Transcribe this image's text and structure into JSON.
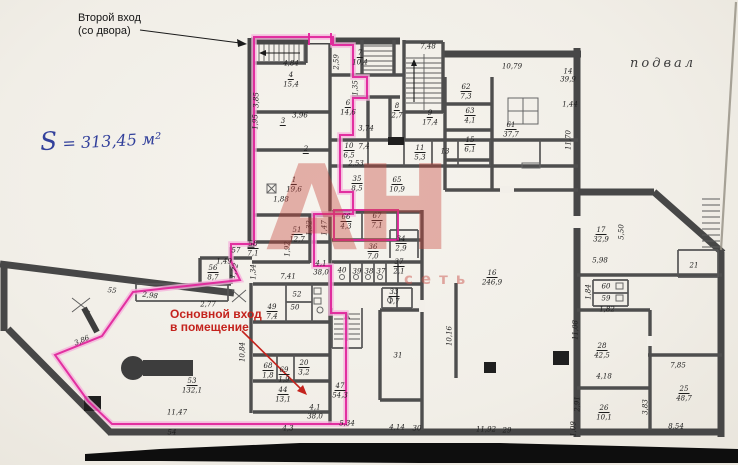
{
  "annotations": {
    "second_entrance_line1": "Второй вход",
    "second_entrance_line2": "(со двора)",
    "floor_label": "подвал",
    "handwritten_area_s": "S",
    "handwritten_area_rest": "= 313,45 м²",
    "main_entrance_line1": "Основной вход",
    "main_entrance_line2": "в помещение"
  },
  "watermark": {
    "big_text": "АН",
    "small_text": "сеть"
  },
  "colors": {
    "highlight_magenta": "#e0249a",
    "entrance_red": "#c4231d",
    "handwriting_blue": "#32409b",
    "wall_gray": "#4a4a4a",
    "paper": "#f2efe9",
    "scan_band_black": "#0e0e0e",
    "watermark_red": "#cc5a52"
  },
  "plan": {
    "labels": [
      {
        "t": "4",
        "x": 291,
        "y": 76,
        "cl": "rn"
      },
      {
        "t": "15,4",
        "x": 291,
        "y": 85
      },
      {
        "t": "3",
        "x": 283,
        "y": 122,
        "cl": "rn"
      },
      {
        "t": "2",
        "x": 306,
        "y": 150,
        "cl": "rn"
      },
      {
        "t": "1",
        "x": 294,
        "y": 181,
        "cl": "rn"
      },
      {
        "t": "19,6",
        "x": 294,
        "y": 190
      },
      {
        "t": "51",
        "x": 297,
        "y": 231,
        "cl": "rn"
      },
      {
        "t": "12,7",
        "x": 297,
        "y": 240
      },
      {
        "t": "58",
        "x": 253,
        "y": 245,
        "cl": "rn"
      },
      {
        "t": "7,1",
        "x": 253,
        "y": 254
      },
      {
        "t": "56",
        "x": 213,
        "y": 269,
        "cl": "rn"
      },
      {
        "t": "8,7",
        "x": 213,
        "y": 278
      },
      {
        "t": "7",
        "x": 360,
        "y": 54,
        "cl": "rn"
      },
      {
        "t": "10,4",
        "x": 360,
        "y": 63
      },
      {
        "t": "6",
        "x": 348,
        "y": 104,
        "cl": "rn"
      },
      {
        "t": "14,6",
        "x": 348,
        "y": 113
      },
      {
        "t": "8",
        "x": 397,
        "y": 107,
        "cl": "rn"
      },
      {
        "t": "2,7",
        "x": 397,
        "y": 116
      },
      {
        "t": "9",
        "x": 430,
        "y": 114,
        "cl": "rn"
      },
      {
        "t": "17,4",
        "x": 430,
        "y": 123
      },
      {
        "t": "62",
        "x": 466,
        "y": 88,
        "cl": "rn"
      },
      {
        "t": "7,3",
        "x": 466,
        "y": 97
      },
      {
        "t": "63",
        "x": 470,
        "y": 112,
        "cl": "rn"
      },
      {
        "t": "4,1",
        "x": 470,
        "y": 121
      },
      {
        "t": "61",
        "x": 511,
        "y": 126,
        "cl": "rn"
      },
      {
        "t": "37,7",
        "x": 511,
        "y": 135
      },
      {
        "t": "15",
        "x": 470,
        "y": 141,
        "cl": "rn"
      },
      {
        "t": "6,1",
        "x": 470,
        "y": 150
      },
      {
        "t": "13",
        "x": 445,
        "y": 152
      },
      {
        "t": "10",
        "x": 349,
        "y": 147,
        "cl": "rn"
      },
      {
        "t": "6,5",
        "x": 349,
        "y": 156
      },
      {
        "t": "7,4",
        "x": 364,
        "y": 147
      },
      {
        "t": "2,53",
        "x": 356,
        "y": 164
      },
      {
        "t": "11",
        "x": 420,
        "y": 149,
        "cl": "rn"
      },
      {
        "t": "5,3",
        "x": 420,
        "y": 158
      },
      {
        "t": "35",
        "x": 357,
        "y": 180,
        "cl": "rn"
      },
      {
        "t": "8,5",
        "x": 357,
        "y": 189
      },
      {
        "t": "65",
        "x": 397,
        "y": 181,
        "cl": "rn"
      },
      {
        "t": "10,9",
        "x": 397,
        "y": 190
      },
      {
        "t": "66",
        "x": 346,
        "y": 218,
        "cl": "rn"
      },
      {
        "t": "4,3",
        "x": 346,
        "y": 227
      },
      {
        "t": "67",
        "x": 377,
        "y": 217,
        "cl": "rn"
      },
      {
        "t": "7,1",
        "x": 377,
        "y": 226
      },
      {
        "t": "36",
        "x": 373,
        "y": 248,
        "cl": "rn"
      },
      {
        "t": "7,0",
        "x": 373,
        "y": 257
      },
      {
        "t": "34",
        "x": 401,
        "y": 240,
        "cl": "rn"
      },
      {
        "t": "2,9",
        "x": 401,
        "y": 249
      },
      {
        "t": "37",
        "x": 399,
        "y": 263,
        "cl": "rn"
      },
      {
        "t": "2,1",
        "x": 399,
        "y": 272
      },
      {
        "t": "40",
        "x": 342,
        "y": 271
      },
      {
        "t": "39",
        "x": 357,
        "y": 272
      },
      {
        "t": "38",
        "x": 369,
        "y": 272
      },
      {
        "t": "37",
        "x": 381,
        "y": 272
      },
      {
        "t": "33",
        "x": 394,
        "y": 293,
        "cl": "rn"
      },
      {
        "t": "1,7",
        "x": 394,
        "y": 302
      },
      {
        "t": "31",
        "x": 398,
        "y": 356
      },
      {
        "t": "49",
        "x": 272,
        "y": 308,
        "cl": "rn"
      },
      {
        "t": "7,4",
        "x": 272,
        "y": 317
      },
      {
        "t": "52",
        "x": 297,
        "y": 295
      },
      {
        "t": "50",
        "x": 295,
        "y": 308
      },
      {
        "t": "68",
        "x": 268,
        "y": 367,
        "cl": "rn"
      },
      {
        "t": "1,8",
        "x": 268,
        "y": 376
      },
      {
        "t": "69",
        "x": 284,
        "y": 371,
        "cl": "rn"
      },
      {
        "t": "1,9",
        "x": 284,
        "y": 380
      },
      {
        "t": "20",
        "x": 304,
        "y": 364,
        "cl": "rn"
      },
      {
        "t": "3,2",
        "x": 304,
        "y": 373
      },
      {
        "t": "44",
        "x": 283,
        "y": 391,
        "cl": "rn"
      },
      {
        "t": "13,1",
        "x": 283,
        "y": 400
      },
      {
        "t": "47",
        "x": 340,
        "y": 387,
        "cl": "rn"
      },
      {
        "t": "54,3",
        "x": 340,
        "y": 396
      },
      {
        "t": "53",
        "x": 192,
        "y": 382,
        "cl": "rn"
      },
      {
        "t": "132,1",
        "x": 192,
        "y": 391
      },
      {
        "t": "16",
        "x": 492,
        "y": 274,
        "cl": "rn"
      },
      {
        "t": "246,9",
        "x": 492,
        "y": 283
      },
      {
        "t": "17",
        "x": 601,
        "y": 231,
        "cl": "rn"
      },
      {
        "t": "32,9",
        "x": 601,
        "y": 240
      },
      {
        "t": "21",
        "x": 694,
        "y": 266
      },
      {
        "t": "60",
        "x": 606,
        "y": 287
      },
      {
        "t": "59",
        "x": 606,
        "y": 299
      },
      {
        "t": "28",
        "x": 602,
        "y": 347,
        "cl": "rn"
      },
      {
        "t": "42,5",
        "x": 602,
        "y": 356
      },
      {
        "t": "26",
        "x": 604,
        "y": 409,
        "cl": "rn"
      },
      {
        "t": "10,1",
        "x": 604,
        "y": 418
      },
      {
        "t": "25",
        "x": 684,
        "y": 390,
        "cl": "rn"
      },
      {
        "t": "48,7",
        "x": 684,
        "y": 399
      },
      {
        "t": "30",
        "x": 417,
        "y": 429
      },
      {
        "t": "29",
        "x": 507,
        "y": 431
      },
      {
        "t": "4,84",
        "x": 291,
        "y": 64
      },
      {
        "t": "3,85",
        "x": 257,
        "y": 100,
        "r": -90
      },
      {
        "t": "1,95",
        "x": 256,
        "y": 122,
        "r": -90
      },
      {
        "t": "3,96",
        "x": 300,
        "y": 116
      },
      {
        "t": "1,88",
        "x": 281,
        "y": 200
      },
      {
        "t": "2,59",
        "x": 337,
        "y": 62,
        "r": -90
      },
      {
        "t": "1,35",
        "x": 356,
        "y": 88,
        "r": -90
      },
      {
        "t": "3,74",
        "x": 366,
        "y": 129
      },
      {
        "t": "7,48",
        "x": 428,
        "y": 47
      },
      {
        "t": "10,79",
        "x": 512,
        "y": 67
      },
      {
        "t": "14",
        "x": 568,
        "y": 72
      },
      {
        "t": "39,9",
        "x": 568,
        "y": 80
      },
      {
        "t": "1,44",
        "x": 570,
        "y": 105
      },
      {
        "t": "11,70",
        "x": 569,
        "y": 140,
        "r": -90
      },
      {
        "t": "1,32",
        "x": 310,
        "y": 228,
        "r": -90
      },
      {
        "t": "1,47",
        "x": 325,
        "y": 228,
        "r": -90
      },
      {
        "t": "1,92",
        "x": 288,
        "y": 249,
        "r": -90
      },
      {
        "t": "57",
        "x": 236,
        "y": 251
      },
      {
        "t": "1,49",
        "x": 224,
        "y": 262
      },
      {
        "t": "1,72",
        "x": 235,
        "y": 271,
        "r": -75
      },
      {
        "t": "1,34",
        "x": 254,
        "y": 272,
        "r": -90
      },
      {
        "t": "2,77",
        "x": 208,
        "y": 305
      },
      {
        "t": "7,41",
        "x": 288,
        "y": 277
      },
      {
        "t": "55",
        "x": 112,
        "y": 291,
        "r": 7
      },
      {
        "t": "2,98",
        "x": 150,
        "y": 296,
        "r": 7
      },
      {
        "t": "3,86",
        "x": 82,
        "y": 341,
        "r": -24
      },
      {
        "t": "11,47",
        "x": 177,
        "y": 413
      },
      {
        "t": "54",
        "x": 172,
        "y": 433
      },
      {
        "t": "10,84",
        "x": 243,
        "y": 352,
        "r": -90
      },
      {
        "t": "4,1",
        "x": 321,
        "y": 264
      },
      {
        "t": "38,0",
        "x": 321,
        "y": 273
      },
      {
        "t": "4,1",
        "x": 315,
        "y": 408
      },
      {
        "t": "38,0",
        "x": 315,
        "y": 417
      },
      {
        "t": "5,34",
        "x": 347,
        "y": 424
      },
      {
        "t": "4,3",
        "x": 288,
        "y": 429
      },
      {
        "t": "10,16",
        "x": 450,
        "y": 336,
        "r": -90
      },
      {
        "t": "4,14",
        "x": 397,
        "y": 428
      },
      {
        "t": "11,92",
        "x": 486,
        "y": 430
      },
      {
        "t": "11,08",
        "x": 576,
        "y": 330,
        "r": -90
      },
      {
        "t": "2,91",
        "x": 578,
        "y": 404,
        "r": -90
      },
      {
        "t": "1,09",
        "x": 574,
        "y": 429,
        "r": -90
      },
      {
        "t": "5,98",
        "x": 600,
        "y": 261
      },
      {
        "t": "5,50",
        "x": 622,
        "y": 232,
        "r": -90
      },
      {
        "t": "1,84",
        "x": 589,
        "y": 292,
        "r": -90
      },
      {
        "t": "1,82",
        "x": 607,
        "y": 310
      },
      {
        "t": "4,18",
        "x": 604,
        "y": 377
      },
      {
        "t": "7,85",
        "x": 678,
        "y": 366
      },
      {
        "t": "8,54",
        "x": 676,
        "y": 427
      },
      {
        "t": "3,83",
        "x": 646,
        "y": 407,
        "r": -90
      }
    ]
  }
}
